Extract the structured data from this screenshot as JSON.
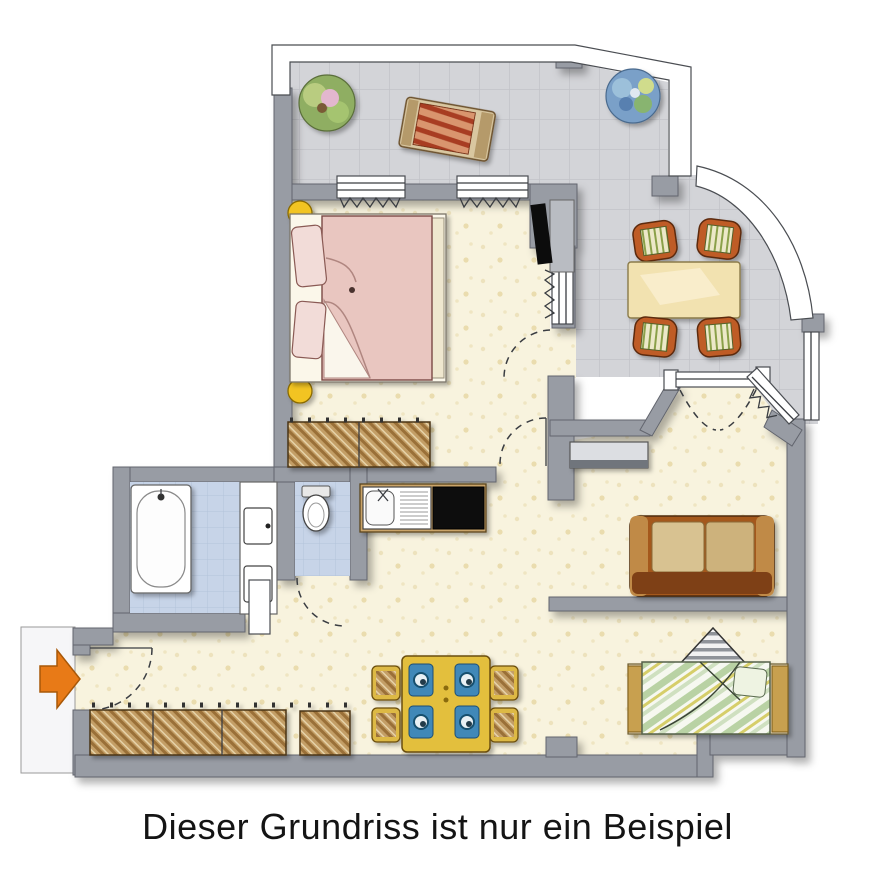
{
  "caption": "Dieser Grundriss ist nur ein Beispiel",
  "colors": {
    "wall_gray": "#989ca4",
    "terrace_floor": "#d3d4d8",
    "interior_floor": "#f8f3de",
    "tile_floor": "#c7d4e8",
    "bed_pink": "#e9c6c0",
    "lamp_yellow": "#f2c420",
    "sofa_brown": "#a4581e",
    "daybed_green": "#cfe0c0",
    "chair_rust": "#bf5b27",
    "table_cream": "#f2e2b0",
    "dining_yellow": "#e3bf3e",
    "plate_blue": "#3f88b8",
    "arrow_orange": "#e87a17",
    "stove_black": "#0b0b0b",
    "wood_hatch": "#c39e66",
    "fixture_white": "#ffffff"
  },
  "floorplan": {
    "rooms": [
      {
        "name": "terrace"
      },
      {
        "name": "conservatory"
      },
      {
        "name": "bedroom"
      },
      {
        "name": "bathroom"
      },
      {
        "name": "wc"
      },
      {
        "name": "kitchen"
      },
      {
        "name": "entrance-hall"
      },
      {
        "name": "living-room"
      }
    ],
    "furniture": {
      "terrace": [
        "potted-plant",
        "sun-lounger",
        "flower-bush"
      ],
      "conservatory": [
        "dining-table",
        "chair",
        "chair",
        "chair",
        "chair"
      ],
      "bedroom": [
        "double-bed",
        "pillow",
        "pillow",
        "bedside-lamp",
        "bedside-lamp",
        "tv",
        "wardrobe",
        "radiator",
        "radiator"
      ],
      "bathroom": [
        "bathtub",
        "washbasin",
        "washbasin"
      ],
      "wc": [
        "toilet"
      ],
      "kitchen": [
        "sink",
        "stove"
      ],
      "entrance-hall": [
        "closet-row",
        "shoe-cabinet",
        "dining-table",
        "chair",
        "chair",
        "chair",
        "chair"
      ],
      "living-room": [
        "sideboard",
        "sofa",
        "daybed",
        "floor-lamp",
        "radiator"
      ]
    },
    "entrance": {
      "arrow_direction": "right"
    }
  }
}
